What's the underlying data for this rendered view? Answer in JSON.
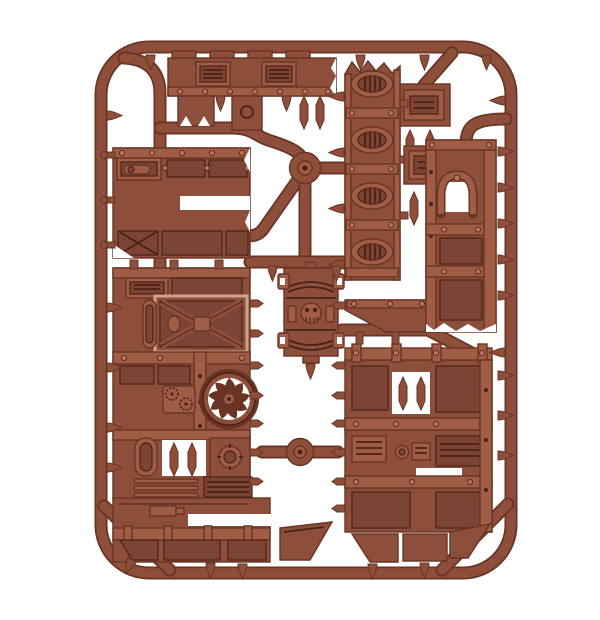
{
  "scene": {
    "type": "product-photograph",
    "description": "Brown plastic model-kit sprue frame holding industrial terrain parts: crenellated rampart rails, louvred vent walls, armoured panels, an X-braced door, a turbine fan, a skull emblem panel and moulding gates, on a plain white background",
    "object": "plastic-model-sprue",
    "material": "brown injection-moulded polystyrene"
  },
  "colors": {
    "background": "#ffffff",
    "plastic": "#8d4e3b",
    "plastic_light": "#a15c46",
    "plastic_lighter": "#b8735c",
    "plastic_dark": "#693424",
    "plastic_deep": "#4a2217",
    "plastic_recess": "#7b4434",
    "highlight": "#cfa28c"
  },
  "parts": {
    "frame": "rounded rectangular sprue runner frame",
    "hub_top": "circular injection hub (upper centre)",
    "hub_bottom": "circular injection hub (lower centre)",
    "top_rail": "crenellated rampart rail with two louvred hatches",
    "top_right_block": "small armoured hatch block",
    "vent_wall": "tall wall strip with four oval louvred vents",
    "arched_wall": "armoured wall section with arched doorway cut-out",
    "small_hatch": "small louvred hatch plate",
    "right_lower_wall": "large panelled wall with pipe and port details",
    "left_upper_wall": "wall section with piston channel and framed panels",
    "left_main_wall": "large wall with X-braced door, turbine fan, cog plate, porthole and pipework",
    "skull_panel": "armoured panel with skull emblem and corner clips",
    "gates": "moulding gates, sprue pins and spindles"
  }
}
